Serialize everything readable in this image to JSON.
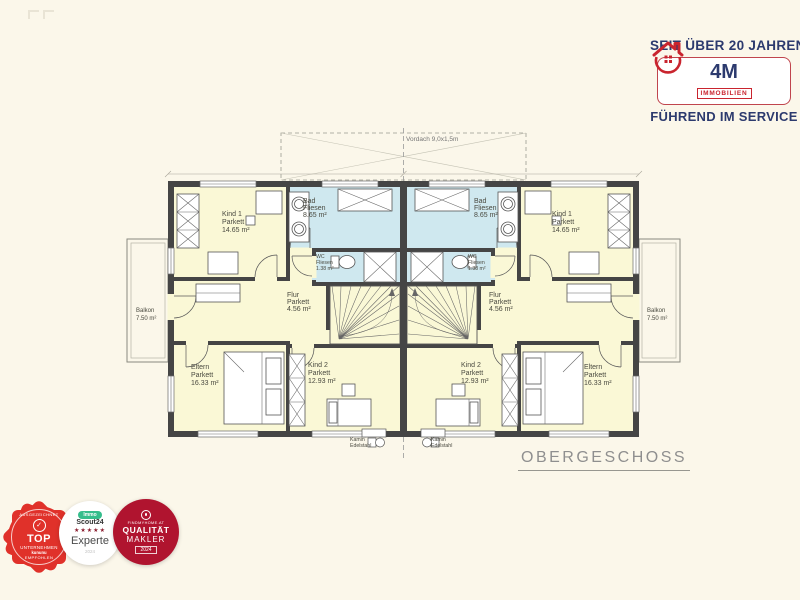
{
  "page": {
    "background": "#fbf7ea"
  },
  "branding": {
    "tagline_top": "SEIT ÜBER 20 JAHREN",
    "logo_text": "4M",
    "logo_subtext": "IMMOBILIEN",
    "tagline_bottom": "FÜHREND IM SERVICE",
    "navy": "#2c3a6e",
    "red": "#c9242e"
  },
  "plan": {
    "floor_title": "OBERGESCHOSS",
    "canopy_label": "Vordach 9,0x1,5m",
    "rooms": {
      "kind1": {
        "name": "Kind 1",
        "floor": "Parkett",
        "area": "14.65 m²"
      },
      "bad": {
        "name": "Bad",
        "floor": "Fliesen",
        "area": "8.65 m²"
      },
      "wc": {
        "name": "WC",
        "floor": "Fliesen",
        "area": "1.38 m²"
      },
      "flur": {
        "name": "Flur",
        "floor": "Parkett",
        "area": "4.56 m²"
      },
      "kind2": {
        "name": "Kind 2",
        "floor": "Parkett",
        "area": "12.93 m²"
      },
      "eltern": {
        "name": "Eltern",
        "floor": "Parkett",
        "area": "16.33 m²"
      },
      "balkon": {
        "name": "Balkon",
        "area": "7.50 m²"
      }
    },
    "chimney": {
      "line1": "Kamin",
      "line2": "Edelstahl"
    },
    "colors": {
      "wall": "#454545",
      "room": "#faf8d6",
      "wet": "#cfe8ef"
    }
  },
  "badges": {
    "kununu": {
      "arc_top": "AUSGEZEICHNET",
      "check": "✓",
      "title": "TOP",
      "subtitle": "UNTERNEHMEN",
      "source": "kununu",
      "arc_bottom": "EMPFOHLEN"
    },
    "scout": {
      "pill": "Immo",
      "name": "Scout24",
      "stars": "★★★★★",
      "label": "Experte",
      "year": "2024"
    },
    "findmyhome": {
      "source": "FINDMYHOME.AT",
      "title": "QUALITÄT",
      "subtitle": "MAKLER",
      "year": "2024"
    }
  }
}
